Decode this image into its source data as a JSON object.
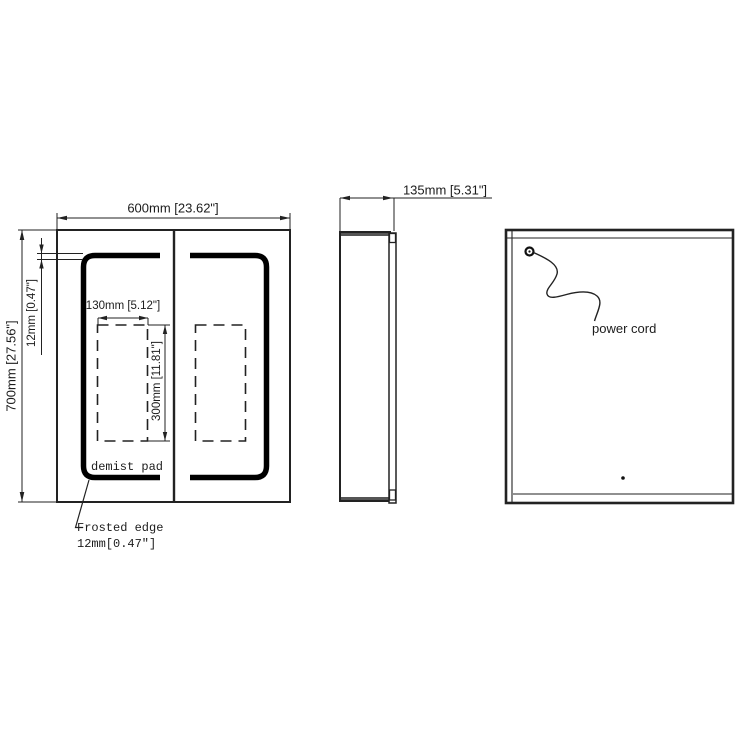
{
  "drawing": {
    "front_view": {
      "width_dimension": "600mm [23.62\"]",
      "height_dimension": "700mm [27.56\"]",
      "frosted_edge_dimension": "12mm [0.47\"]",
      "demist_pad_width_dimension": "130mm [5.12\"]",
      "demist_pad_height_dimension": "300mm [11.81\"]",
      "demist_pad_label": "demist pad",
      "frosted_edge_callout": {
        "line1": "Frosted edge",
        "line2": "12mm[0.47″]"
      }
    },
    "side_view": {
      "depth_dimension": "135mm [5.31\"]"
    },
    "back_view": {
      "power_cord_label": "power cord"
    },
    "colors": {
      "line_color": "#222222",
      "band_color": "#000000",
      "background": "#ffffff"
    }
  }
}
